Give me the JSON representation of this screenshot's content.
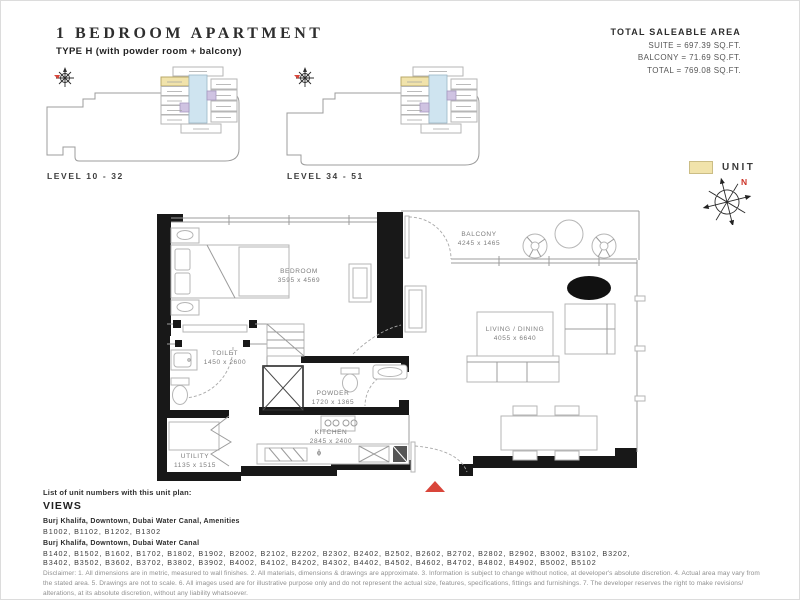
{
  "document": {
    "title": "1 BEDROOM APARTMENT",
    "subtitle": "TYPE H (with powder room + balcony)"
  },
  "saleable_area": {
    "heading": "TOTAL SALEABLE AREA",
    "lines": [
      "SUITE = 697.39 SQ.FT.",
      "BALCONY = 71.69 SQ.FT.",
      "TOTAL = 769.08 SQ.FT."
    ]
  },
  "key_plans": [
    {
      "label": "LEVEL 10 - 32"
    },
    {
      "label": "LEVEL 34 - 51"
    }
  ],
  "legend": {
    "unit_label": "UNIT",
    "north_label": "N"
  },
  "floor_plan": {
    "rooms": [
      {
        "name": "BEDROOM",
        "dims": "3595 x 4569"
      },
      {
        "name": "BALCONY",
        "dims": "4245 x 1465"
      },
      {
        "name": "LIVING / DINING",
        "dims": "4055 x 6640"
      },
      {
        "name": "TOILET",
        "dims": "1450 x 2600"
      },
      {
        "name": "POWDER",
        "dims": "1720 x 1365"
      },
      {
        "name": "KITCHEN",
        "dims": "2845 x 2400"
      },
      {
        "name": "UTILITY",
        "dims": "1135 x 1515"
      }
    ]
  },
  "footer": {
    "list_intro": "List of unit numbers with this unit plan:",
    "views_heading": "VIEWS",
    "view_groups": [
      {
        "title": "Burj Khalifa, Downtown, Dubai Water Canal, Amenities",
        "units_lines": [
          "B1002, B1102, B1202, B1302"
        ]
      },
      {
        "title": "Burj Khalifa, Downtown, Dubai Water Canal",
        "units_lines": [
          "B1402, B1502, B1602, B1702, B1802, B1902, B2002, B2102, B2202, B2302, B2402, B2502, B2602, B2702, B2802, B2902, B3002, B3102, B3202,",
          "B3402, B3502, B3602, B3702, B3802, B3902, B4002, B4102, B4202, B4302, B4402, B4502, B4602, B4702, B4802, B4902, B5002, B5102"
        ]
      }
    ],
    "disclaimer": "Disclaimer: 1. All dimensions are in metric, measured to wall finishes. 2. All materials, dimensions & drawings are approximate. 3. Information is subject to change without notice, at developer's absolute discretion. 4. Actual area may vary from the stated area. 5. Drawings are not to scale. 6. All images used are for illustrative purpose only and do not represent the actual size, features, specifications, fittings and furnishings. 7. The developer reserves the right to make revisions/ alterations, at its absolute discretion, without any liability whatsoever."
  },
  "icons": {
    "compass": "compass-rose",
    "entrance_marker": "red-triangle",
    "unit_swatch": "yellow-square"
  },
  "colors": {
    "unit_highlight": "#f1e3ab",
    "core_blue": "#cfe4f0",
    "unit_purple": "#cfc3e2",
    "wall_black": "#181818",
    "accent_red": "#d9453a"
  }
}
